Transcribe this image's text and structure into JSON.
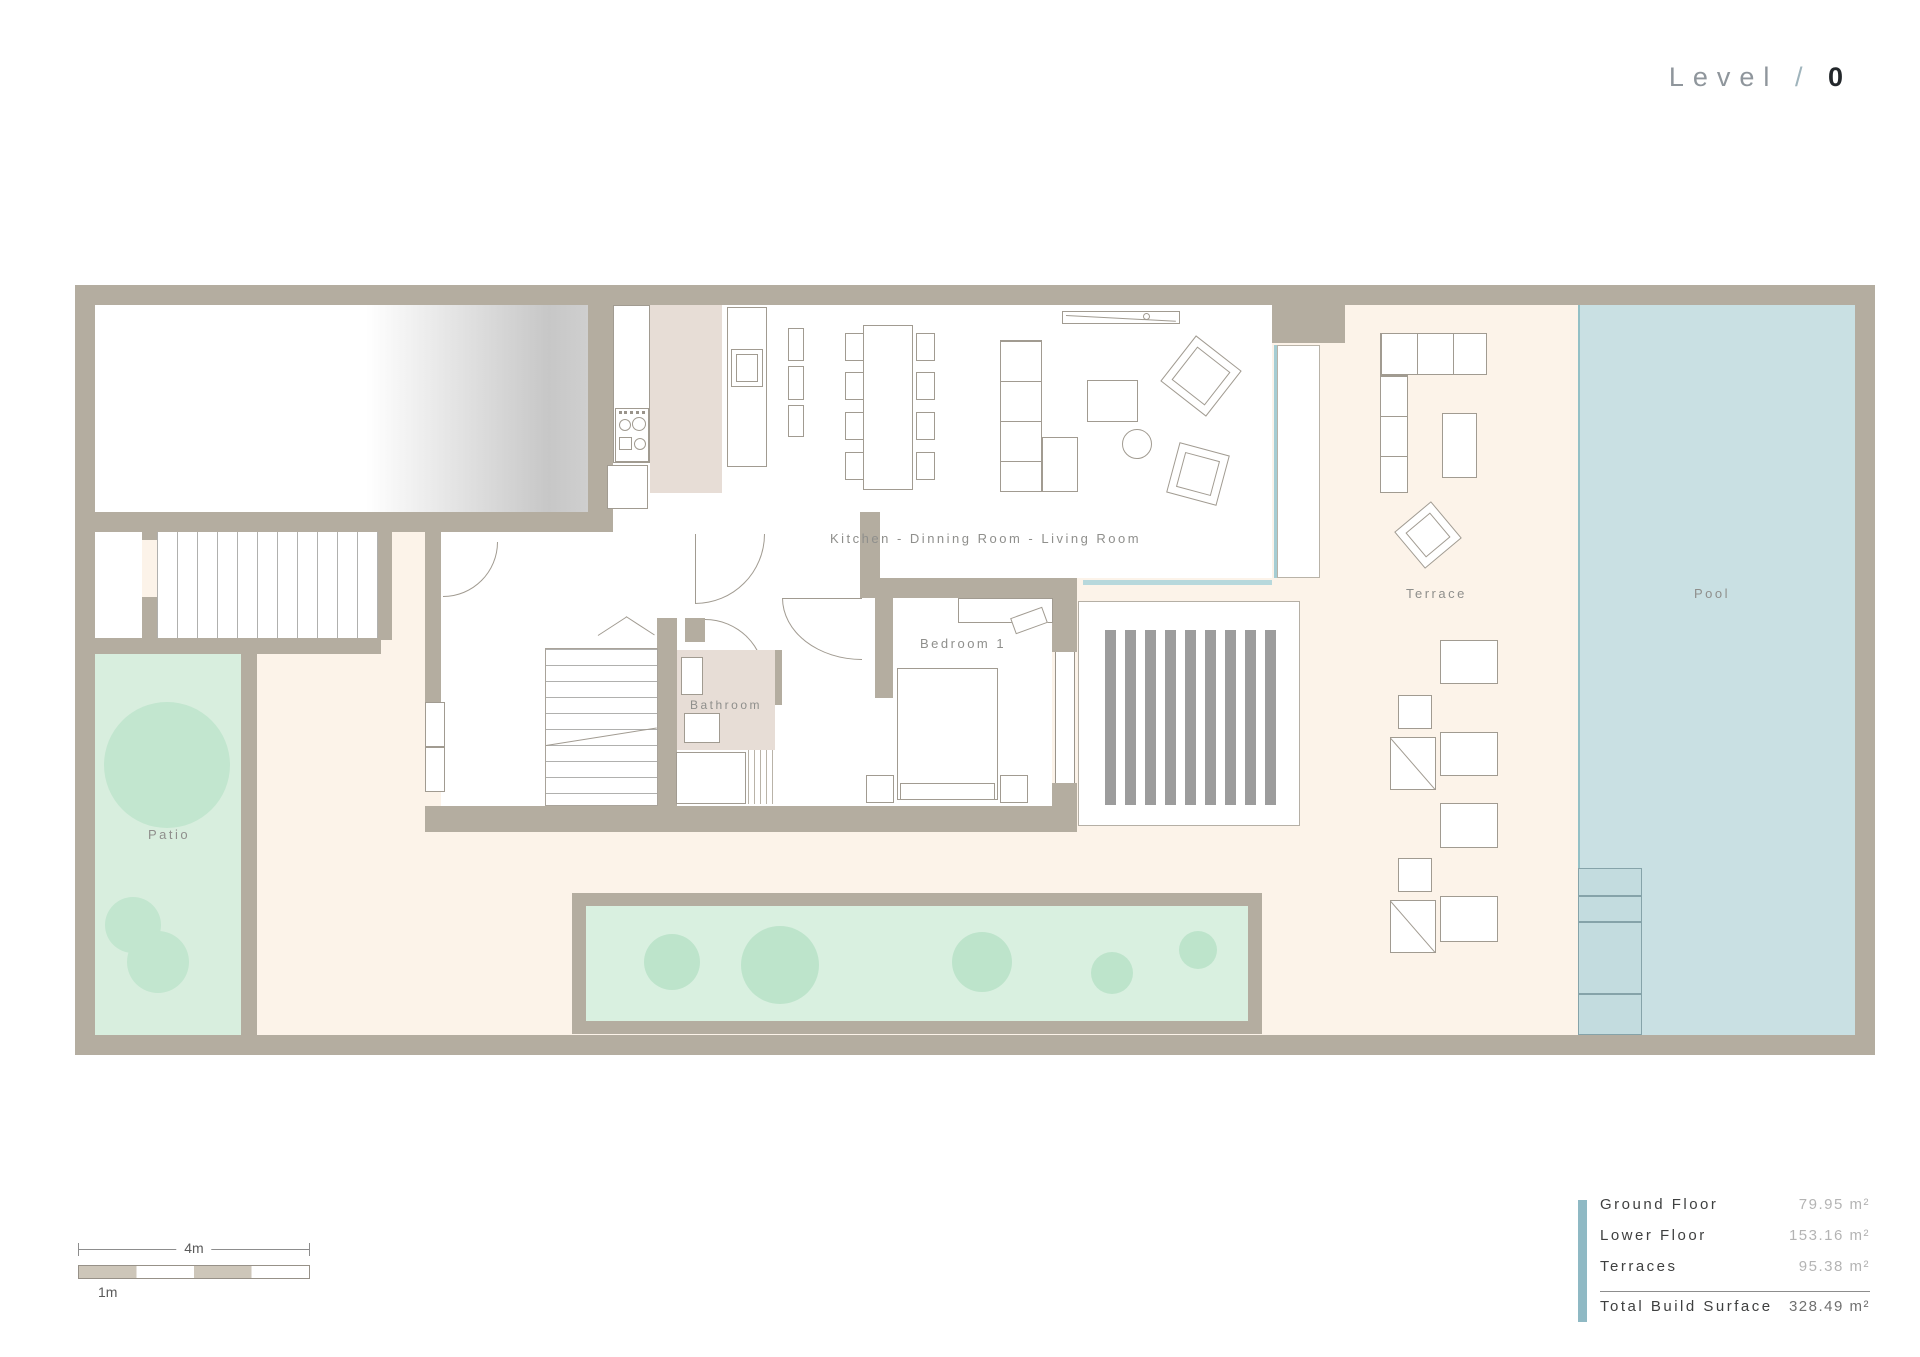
{
  "header": {
    "level_label": "Level",
    "separator": "/",
    "level_number": "0"
  },
  "rooms": {
    "kitchen_living": "Kitchen - Dinning Room - Living Room",
    "bedroom": "Bedroom 1",
    "bathroom": "Bathroom",
    "terrace": "Terrace",
    "pool": "Pool",
    "patio": "Patio"
  },
  "legend": {
    "rows": [
      {
        "label": "Ground Floor",
        "value": "79.95 m²"
      },
      {
        "label": "Lower Floor",
        "value": "153.16 m²"
      },
      {
        "label": "Terraces",
        "value": "95.38 m²"
      }
    ],
    "total": {
      "label": "Total Build Surface",
      "value": "328.49 m²"
    }
  },
  "scale_bar": {
    "total_label": "4m",
    "unit_label": "1m"
  },
  "colors": {
    "wall": "#b4ada0",
    "terrace_floor": "#fcf3e9",
    "pool_water": "#c9e0e3",
    "patio_green": "#d8eede",
    "planter_green": "#d9f0e0",
    "vegetation": "#c2e6cf",
    "tile_floor": "#e7ddd6",
    "deck_stripes": "#9c9c9c",
    "legend_accent": "#8fb9c4",
    "furniture_outline": "#a19b91"
  }
}
